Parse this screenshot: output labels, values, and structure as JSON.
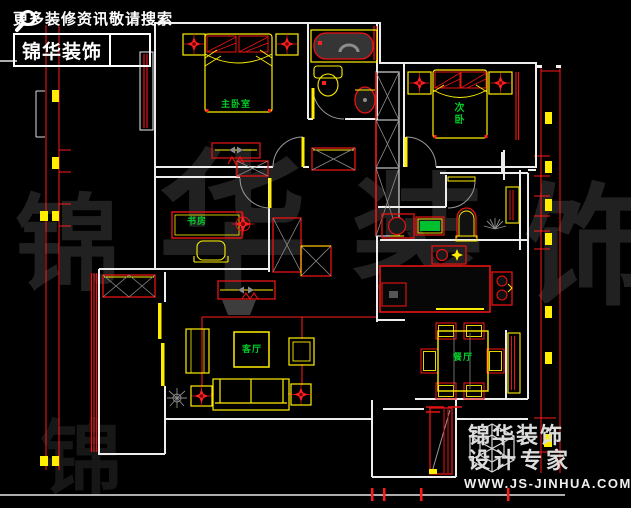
{
  "promo": {
    "tagline": "更多装修资讯敬请搜索",
    "brand": "锦华装饰",
    "icon": "magnifier"
  },
  "logo": {
    "brand": "锦华装饰",
    "subtitle": "设计专家",
    "website": "WWW.JS-JINHUA.COM",
    "icon": "wireframe-cube"
  },
  "watermark": {
    "c1": "锦",
    "c2": "华",
    "c3": "装",
    "c4": "饰"
  },
  "rooms": {
    "master": "主卧室",
    "second": "次卧",
    "study": "书房",
    "living": "客厅",
    "dining": "餐厅"
  },
  "colors": {
    "background": "#000000",
    "wall": "#ededed",
    "fixture_red": "#e81313",
    "furniture_yellow": "#ffee00",
    "label_green": "#00cd28",
    "hatch_gray": "#8c8c8c",
    "watermark_gray": "#212121"
  }
}
